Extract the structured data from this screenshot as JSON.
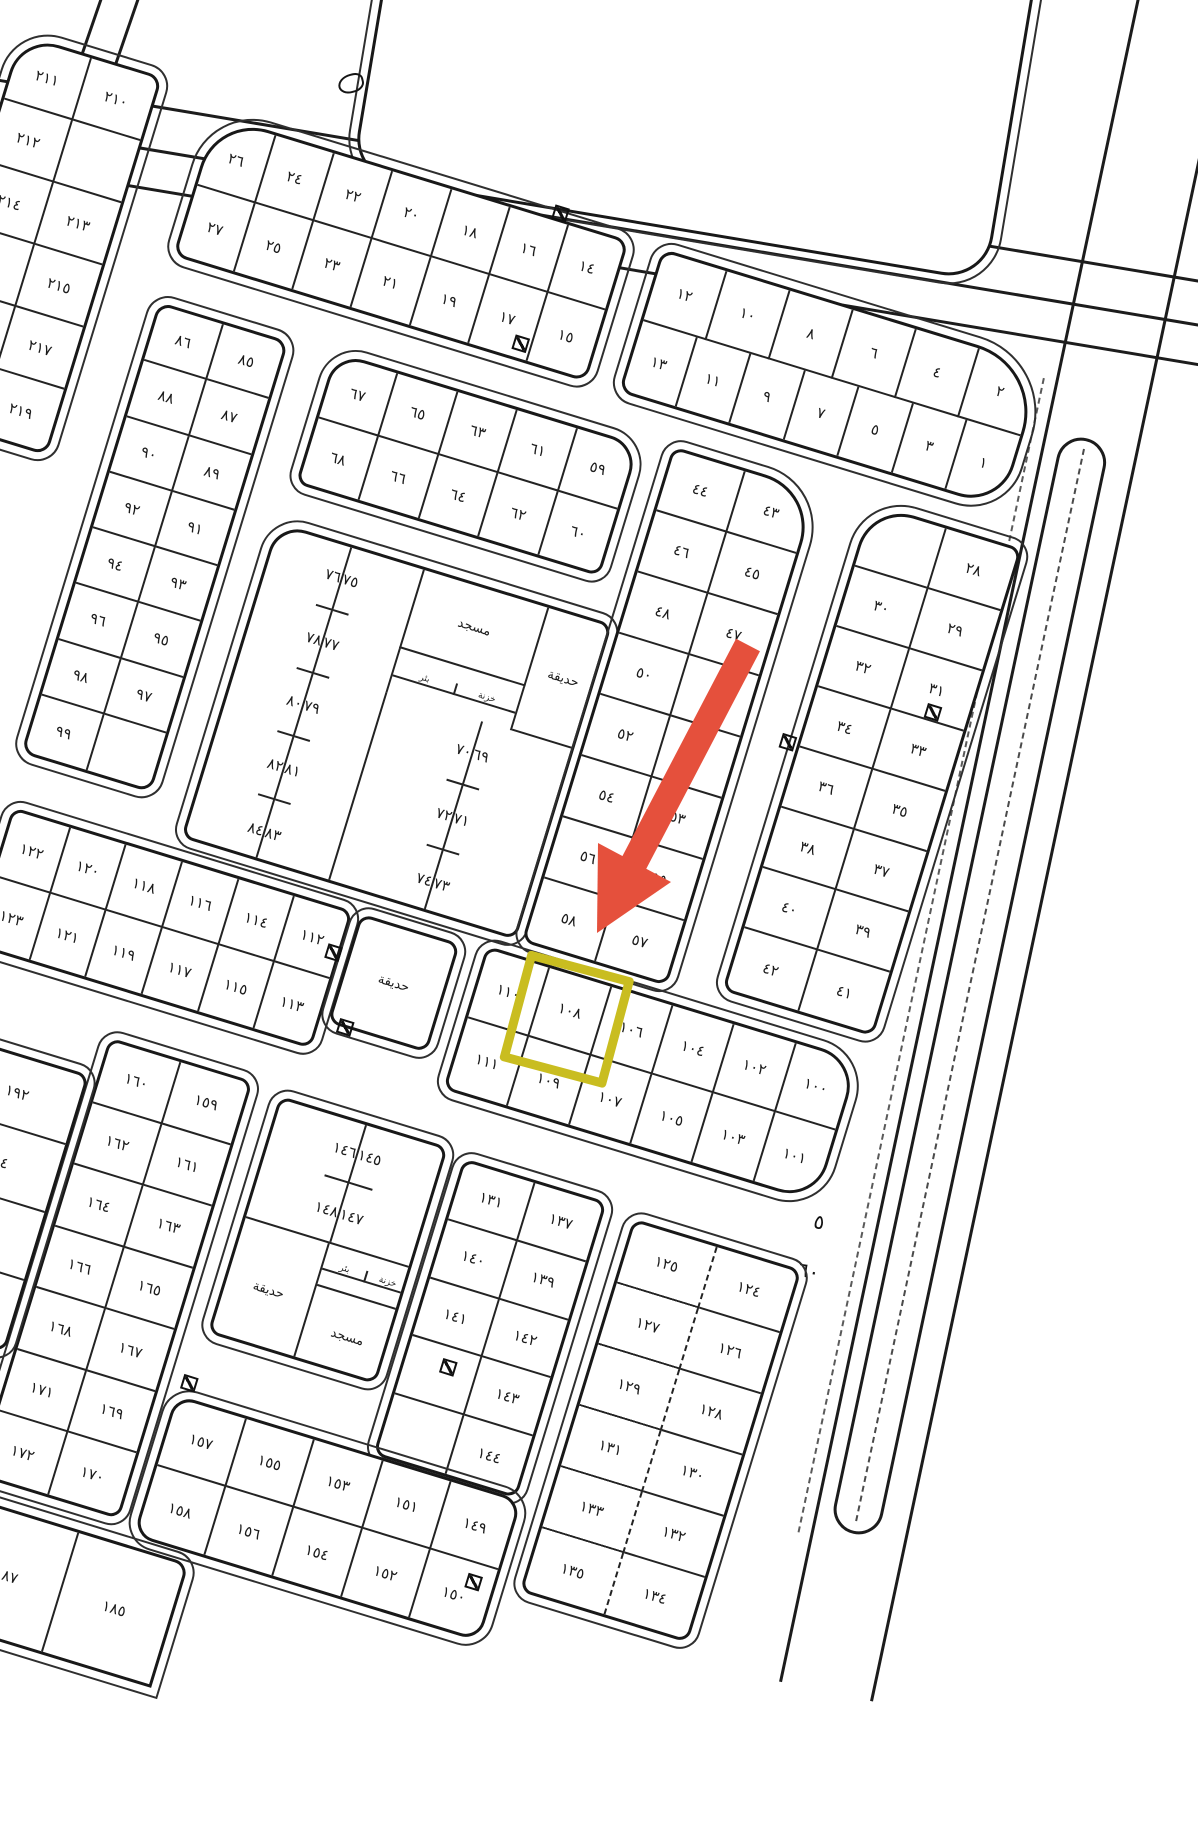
{
  "page": {
    "type": "scanned cadastral subdivision map",
    "language": "Arabic"
  },
  "map": {
    "labels": {
      "mosque": "مسجد",
      "garden": "حديقة",
      "well": "بئر",
      "tank": "خزنة"
    },
    "road_labels": {
      "street_number": "٥",
      "street_width": "٦٠"
    },
    "blocks": {
      "a": {
        "plots": [
          [
            "٢١١",
            "٢١٠"
          ],
          [
            "٢١٢",
            ""
          ],
          [
            "٢١٤",
            "٢١٣"
          ],
          [
            "",
            "٢١٥"
          ],
          [
            "",
            "٢١٧"
          ],
          [
            "",
            "٢١٩"
          ]
        ]
      },
      "b": {
        "plots": [
          [
            "٢٦",
            "٢٤",
            "٢٢",
            "٢٠",
            "١٨",
            "١٦",
            "١٤"
          ],
          [
            "٢٧",
            "٢٥",
            "٢٣",
            "٢١",
            "١٩",
            "١٧",
            "١٥"
          ]
        ]
      },
      "c": {
        "plots": [
          [
            "١٢",
            "١٠",
            "٨",
            "٦",
            "٤",
            "٢"
          ],
          [
            "١٣",
            "١١",
            "٩",
            "٧",
            "٥",
            "٣",
            "١"
          ]
        ]
      },
      "d": {
        "plots": [
          [
            "٨٦",
            "٨٥"
          ],
          [
            "٨٨",
            "٨٧"
          ],
          [
            "٩٠",
            "٨٩"
          ],
          [
            "٩٢",
            "٩١"
          ],
          [
            "٩٤",
            "٩٣"
          ],
          [
            "٩٦",
            "٩٥"
          ],
          [
            "٩٨",
            "٩٧"
          ],
          [
            "٩٩",
            ""
          ]
        ]
      },
      "e": {
        "plots": [
          [
            "٦٧",
            "٦٥",
            "٦٣",
            "٦١",
            "٥٩"
          ],
          [
            "٦٨",
            "٦٦",
            "٦٤",
            "٦٢",
            "٦٠"
          ]
        ]
      },
      "f": {
        "west": [
          [
            "٧٦",
            "٧٥"
          ],
          [
            "٧٨",
            "٧٧"
          ],
          [
            "٨٠",
            "٧٩"
          ],
          [
            "٨٢",
            "٨١"
          ],
          [
            "٨٤",
            "٨٣"
          ]
        ],
        "east": [
          [
            "٧٠",
            "٦٩"
          ],
          [
            "٧٢",
            "٧١"
          ],
          [
            "٧٤",
            "٧٣"
          ]
        ]
      },
      "g": {
        "plots": [
          [
            "٤٤",
            "٤٣"
          ],
          [
            "٤٦",
            "٤٥"
          ],
          [
            "٤٨",
            "٤٧"
          ],
          [
            "٥٠",
            "٤٩"
          ],
          [
            "٥٢",
            "٥١"
          ],
          [
            "٥٤",
            "٥٣"
          ],
          [
            "٥٦",
            "٥٥"
          ],
          [
            "٥٨",
            "٥٧"
          ]
        ]
      },
      "h": {
        "plots": [
          [
            "",
            "٢٨"
          ],
          [
            "٣٠",
            "٢٩"
          ],
          [
            "٣٢",
            "٣١"
          ],
          [
            "٣٤",
            "٣٣"
          ],
          [
            "٣٦",
            "٣٥"
          ],
          [
            "٣٨",
            "٣٧"
          ],
          [
            "٤٠",
            "٣٩"
          ],
          [
            "٤٢",
            "٤١"
          ]
        ]
      },
      "i": {
        "plots": [
          [
            "١٢٢",
            "١٢٠",
            "١١٨",
            "١١٦",
            "١١٤",
            "١١٢"
          ],
          [
            "١٢٣",
            "١٢١",
            "١١٩",
            "١١٧",
            "١١٥",
            "١١٣"
          ]
        ]
      },
      "k": {
        "plots": [
          [
            "١١٠",
            "١٠٨",
            "١٠٦",
            "١٠٤",
            "١٠٢",
            "١٠٠"
          ],
          [
            "١١١",
            "١٠٩",
            "١٠٧",
            "١٠٥",
            "١٠٣",
            "١٠١"
          ]
        ]
      },
      "l": {
        "plots": [
          [
            "١٦٠",
            "١٥٩"
          ],
          [
            "١٦٢",
            "١٦١"
          ],
          [
            "١٦٤",
            "١٦٣"
          ],
          [
            "١٦٦",
            "١٦٥"
          ],
          [
            "١٦٨",
            "١٦٧"
          ],
          [
            "١٧١",
            "١٦٩"
          ],
          [
            "١٧٢",
            "١٧٠"
          ]
        ]
      },
      "m": {
        "plots": [
          [
            "١٨٧",
            "١٨٥"
          ]
        ]
      },
      "le": {
        "plots": [
          [
            "١٩٢"
          ],
          [
            "١٩٤"
          ],
          [
            ""
          ],
          [
            ""
          ]
        ]
      },
      "n": {
        "plots": [
          [
            "١٤٦",
            "١٤٥"
          ],
          [
            "١٤٨",
            "١٤٧"
          ]
        ]
      },
      "o": {
        "plots": [
          [
            "١٣١",
            "١٣٧"
          ],
          [
            "١٤٠",
            "١٣٩"
          ],
          [
            "١٤١",
            "١٤٢"
          ],
          [
            "",
            "١٤٣"
          ],
          [
            "",
            "١٤٤"
          ]
        ]
      },
      "p": {
        "plots": [
          [
            "١٢٥",
            "١٢٤"
          ],
          [
            "١٢٧",
            "١٢٦"
          ],
          [
            "١٢٩",
            "١٢٨"
          ],
          [
            "١٣١",
            "١٣٠"
          ],
          [
            "١٣٣",
            "١٣٢"
          ],
          [
            "١٣٥",
            "١٣٤"
          ]
        ]
      },
      "q": {
        "plots": [
          [
            "١٥٧",
            "١٥٥",
            "١٥٣",
            "١٥١",
            "١٤٩"
          ],
          [
            "١٥٨",
            "١٥٦",
            "١٥٤",
            "١٥٢",
            "١٥٠"
          ]
        ]
      }
    }
  },
  "annotations": {
    "highlighted_plot": "١٠٨",
    "highlight_color": "#c9bd20",
    "arrow_color": "#e5503c"
  }
}
